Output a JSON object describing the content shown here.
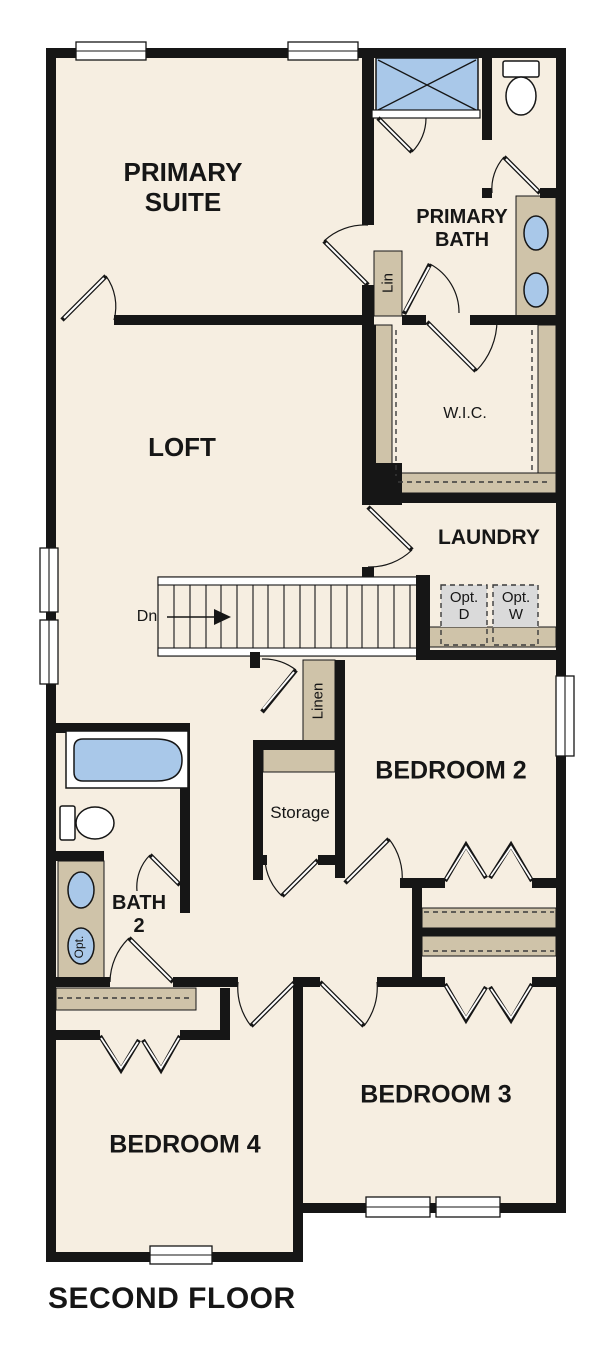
{
  "title": {
    "floor_label": "SECOND FLOOR"
  },
  "colors": {
    "wall": "#161616",
    "floor": "#f6eee1",
    "tan": "#cfc3a9",
    "blue": "#a9c8e9",
    "gray": "#dadada",
    "ink": "#161616"
  },
  "rooms": {
    "primary_suite": {
      "line1": "PRIMARY",
      "line2": "SUITE"
    },
    "loft": {
      "label": "LOFT"
    },
    "primary_bath": {
      "line1": "PRIMARY",
      "line2": "BATH"
    },
    "wic": {
      "label": "W.I.C."
    },
    "laundry": {
      "label": "LAUNDRY"
    },
    "bedroom2": {
      "label": "BEDROOM 2"
    },
    "bedroom3": {
      "label": "BEDROOM 3"
    },
    "bedroom4": {
      "label": "BEDROOM 4"
    },
    "bath2": {
      "line1": "BATH",
      "line2": "2"
    }
  },
  "closets": {
    "lin_label": "Lin",
    "linen_label": "Linen",
    "storage_label": "Storage"
  },
  "laundry_appliances": {
    "optional_dryer": {
      "line1": "Opt.",
      "line2": "D"
    },
    "optional_washer": {
      "line1": "Opt.",
      "line2": "W"
    }
  },
  "stairs": {
    "down_label": "Dn"
  },
  "bath2_fixtures": {
    "optional_sink_label": "Opt."
  }
}
